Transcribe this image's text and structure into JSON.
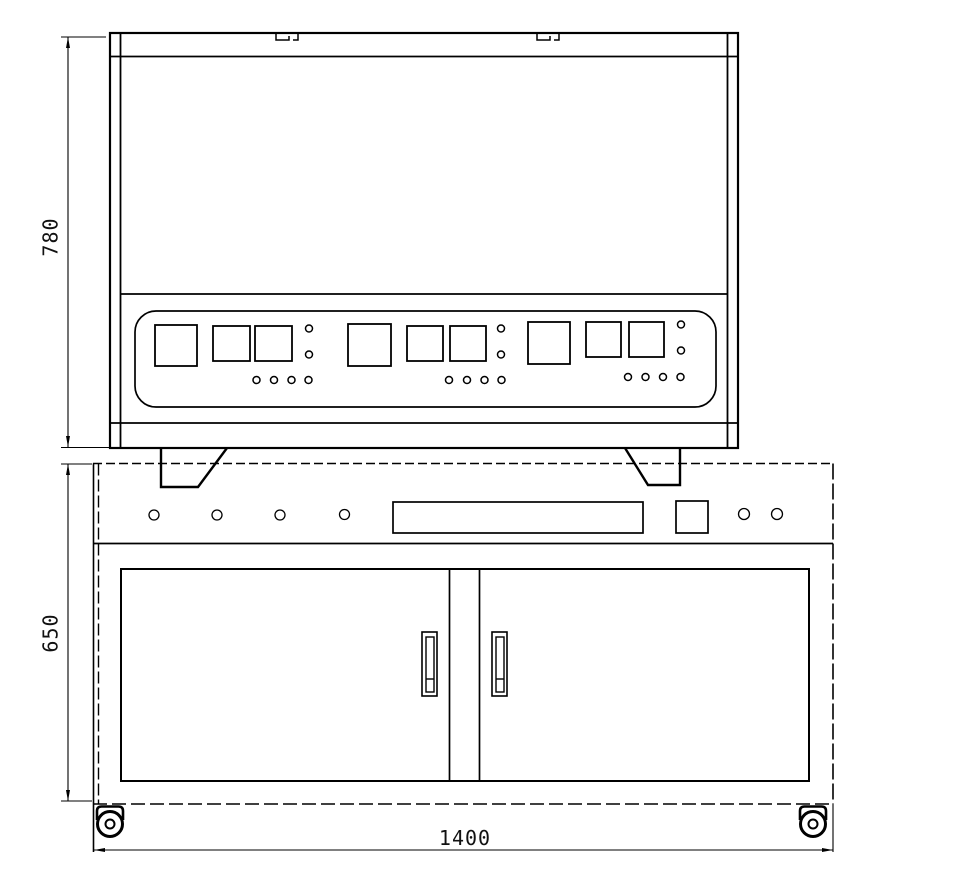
{
  "drawing": {
    "kind": "technical-front-elevation",
    "colors": {
      "line": "#000000",
      "background": "#ffffff",
      "dimension_text": "#111111"
    }
  },
  "dimensions": {
    "machine_height_label": "780",
    "cabinet_height_label": "650",
    "cabinet_width_label": "1400"
  },
  "machine": {
    "lid_tabs": 2,
    "feet": 2,
    "control_panel": {
      "groups": 3,
      "large_squares_per_group": 1,
      "small_squares_per_group": 2,
      "stacked_indicators_per_group": 2,
      "row_indicators_per_group": 4
    }
  },
  "cabinet": {
    "knobs": 4,
    "display_slots": 1,
    "switch_squares": 1,
    "indicator_lights": 2,
    "doors": 2,
    "door_handles": 2,
    "casters": 2
  }
}
